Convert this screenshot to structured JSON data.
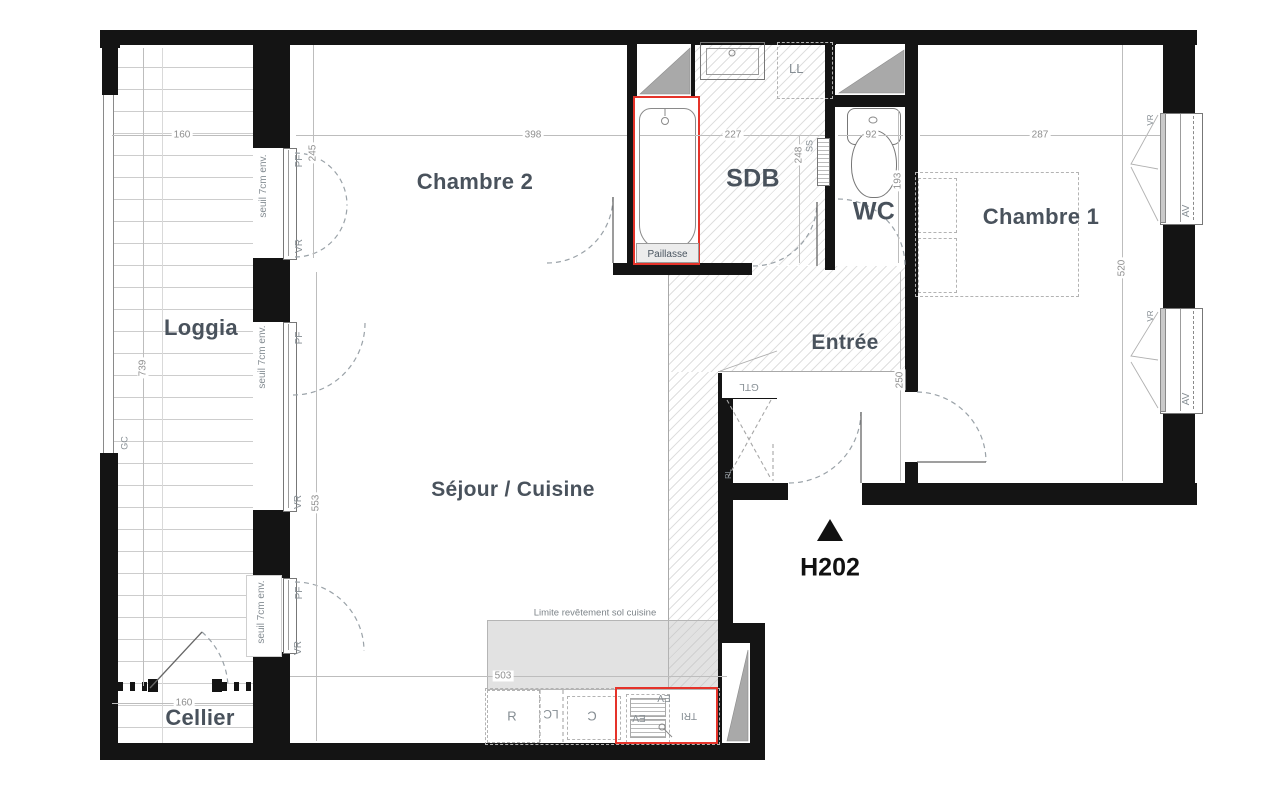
{
  "marker": {
    "code": "H202"
  },
  "rooms": {
    "loggia": "Loggia",
    "chambre2": "Chambre 2",
    "sdb": "SDB",
    "wc": "WC",
    "chambre1": "Chambre 1",
    "sejour": "Séjour / Cuisine",
    "entree": "Entrée",
    "cellier": "Cellier"
  },
  "dims": {
    "loggia_w": "160",
    "loggia_h": "739",
    "chambre2_w": "398",
    "chambre2_win_h": "245",
    "sdb_w": "227",
    "sdb_h": "248",
    "wc_w": "92",
    "wc_h": "193",
    "chambre1_w": "287",
    "chambre1_h": "520",
    "sejour_h": "553",
    "sejour_w": "503",
    "entree_d": "250",
    "cellier_w": "160"
  },
  "tags": {
    "pf": "PF",
    "vr": "VR",
    "av": "AV",
    "ll": "LL",
    "ss": "SS",
    "gc": "GC",
    "gtl": "GTL",
    "pl": "PL",
    "seuil": "seuil 7cm env.",
    "r": "R",
    "lc": "LC",
    "c": "C",
    "ev": "EV",
    "tri": "TRI"
  },
  "annotations": {
    "paillasse": "Paillasse",
    "limite": "Limite revêtement sol cuisine"
  },
  "colors": {
    "wall": "#141414",
    "red": "#e5332a",
    "room_label": "#49525c",
    "dim": "#8f8f8f"
  }
}
